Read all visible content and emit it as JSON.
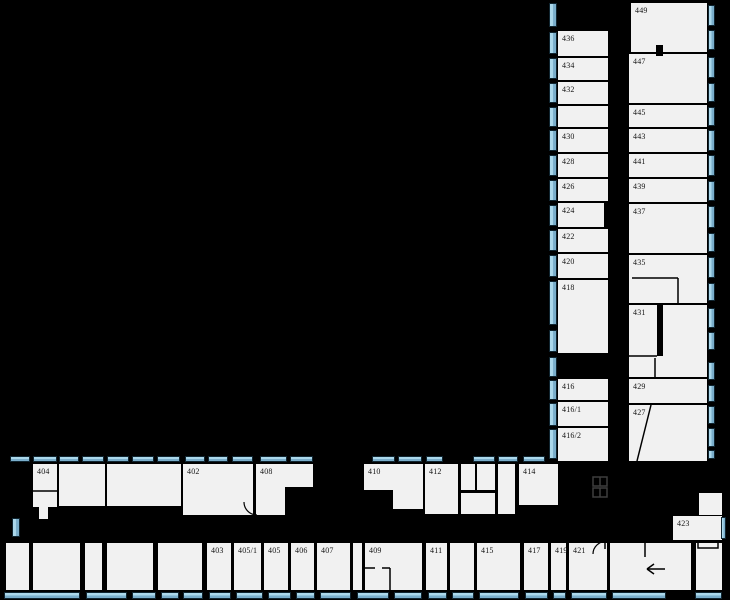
{
  "page": {
    "type": "building-floor-plan",
    "floor_hint": "rooms 402-449"
  },
  "canvas": {
    "width": 730,
    "height": 600
  },
  "colors": {
    "background": "#000000",
    "wall": "#000000",
    "room_fill": "#f1f1f1",
    "window_fill": "#8ec4e0",
    "window_border": "#102530",
    "label_text": "#161616",
    "shaft_symbol": "#3e3e3e"
  },
  "floorplan": {
    "room_labels": [
      "404",
      "402",
      "408",
      "410",
      "412",
      "414",
      "403",
      "405/1",
      "405",
      "406",
      "407",
      "409",
      "411",
      "415",
      "417",
      "419",
      "421",
      "423",
      "436",
      "434",
      "432",
      "430",
      "428",
      "426",
      "424",
      "422",
      "420",
      "418",
      "416",
      "416/1",
      "416/2",
      "449",
      "447",
      "445",
      "443",
      "441",
      "439",
      "437",
      "435",
      "431",
      "429",
      "427"
    ],
    "rooms": [
      {
        "label": "436",
        "x": 558,
        "y": 31,
        "w": 50,
        "h": 25
      },
      {
        "label": "434",
        "x": 558,
        "y": 58,
        "w": 50,
        "h": 22
      },
      {
        "label": "432",
        "x": 558,
        "y": 82,
        "w": 50,
        "h": 22
      },
      {
        "label": "",
        "x": 558,
        "y": 106,
        "w": 50,
        "h": 21
      },
      {
        "label": "430",
        "x": 558,
        "y": 129,
        "w": 50,
        "h": 23
      },
      {
        "label": "428",
        "x": 558,
        "y": 154,
        "w": 50,
        "h": 23
      },
      {
        "label": "426",
        "x": 558,
        "y": 179,
        "w": 50,
        "h": 22
      },
      {
        "label": "424",
        "x": 558,
        "y": 203,
        "w": 46,
        "h": 24
      },
      {
        "label": "422",
        "x": 558,
        "y": 229,
        "w": 50,
        "h": 23
      },
      {
        "label": "420",
        "x": 558,
        "y": 254,
        "w": 50,
        "h": 24
      },
      {
        "label": "418",
        "x": 558,
        "y": 280,
        "w": 50,
        "h": 73
      },
      {
        "label": "416",
        "x": 558,
        "y": 379,
        "w": 50,
        "h": 21
      },
      {
        "label": "416/1",
        "x": 558,
        "y": 402,
        "w": 50,
        "h": 24
      },
      {
        "label": "416/2",
        "x": 558,
        "y": 428,
        "w": 50,
        "h": 33
      },
      {
        "label": "449",
        "x": 631,
        "y": 3,
        "w": 76,
        "h": 49
      },
      {
        "label": "447",
        "x": 629,
        "y": 54,
        "w": 78,
        "h": 49
      },
      {
        "label": "445",
        "x": 629,
        "y": 105,
        "w": 78,
        "h": 22
      },
      {
        "label": "443",
        "x": 629,
        "y": 129,
        "w": 78,
        "h": 23
      },
      {
        "label": "441",
        "x": 629,
        "y": 154,
        "w": 78,
        "h": 23
      },
      {
        "label": "439",
        "x": 629,
        "y": 179,
        "w": 78,
        "h": 23
      },
      {
        "label": "437",
        "x": 629,
        "y": 204,
        "w": 78,
        "h": 49
      },
      {
        "label": "435",
        "x": 629,
        "y": 255,
        "w": 78,
        "h": 48
      },
      {
        "label": "431",
        "x": 629,
        "y": 305,
        "w": 78,
        "h": 72
      },
      {
        "label": "429",
        "x": 629,
        "y": 379,
        "w": 78,
        "h": 24
      },
      {
        "label": "427",
        "x": 629,
        "y": 405,
        "w": 78,
        "h": 56
      },
      {
        "label": "404",
        "x": 33,
        "y": 464,
        "w": 24,
        "h": 43
      },
      {
        "label": "",
        "x": 39,
        "y": 507,
        "w": 9,
        "h": 12
      },
      {
        "label": "",
        "x": 59,
        "y": 464,
        "w": 46,
        "h": 42
      },
      {
        "label": "",
        "x": 107,
        "y": 464,
        "w": 74,
        "h": 42
      },
      {
        "label": "402",
        "x": 183,
        "y": 464,
        "w": 70,
        "h": 51
      },
      {
        "label": "408",
        "x": 256,
        "y": 464,
        "w": 57,
        "h": 23
      },
      {
        "label": "",
        "x": 256,
        "y": 487,
        "w": 29,
        "h": 28
      },
      {
        "label": "410",
        "x": 364,
        "y": 464,
        "w": 59,
        "h": 26
      },
      {
        "label": "",
        "x": 393,
        "y": 490,
        "w": 30,
        "h": 19
      },
      {
        "label": "412",
        "x": 425,
        "y": 464,
        "w": 33,
        "h": 50
      },
      {
        "label": "",
        "x": 461,
        "y": 464,
        "w": 14,
        "h": 26
      },
      {
        "label": "",
        "x": 477,
        "y": 464,
        "w": 18,
        "h": 26
      },
      {
        "label": "",
        "x": 461,
        "y": 493,
        "w": 34,
        "h": 21
      },
      {
        "label": "",
        "x": 498,
        "y": 464,
        "w": 17,
        "h": 50
      },
      {
        "label": "414",
        "x": 519,
        "y": 464,
        "w": 39,
        "h": 41
      },
      {
        "label": "",
        "x": 6,
        "y": 543,
        "w": 23,
        "h": 47
      },
      {
        "label": "",
        "x": 33,
        "y": 543,
        "w": 47,
        "h": 47
      },
      {
        "label": "",
        "x": 85,
        "y": 543,
        "w": 17,
        "h": 47
      },
      {
        "label": "",
        "x": 107,
        "y": 543,
        "w": 46,
        "h": 47
      },
      {
        "label": "",
        "x": 158,
        "y": 543,
        "w": 44,
        "h": 47
      },
      {
        "label": "403",
        "x": 207,
        "y": 543,
        "w": 24,
        "h": 47
      },
      {
        "label": "405/1",
        "x": 234,
        "y": 543,
        "w": 27,
        "h": 47
      },
      {
        "label": "405",
        "x": 264,
        "y": 543,
        "w": 24,
        "h": 47
      },
      {
        "label": "406",
        "x": 291,
        "y": 543,
        "w": 23,
        "h": 47
      },
      {
        "label": "407",
        "x": 317,
        "y": 543,
        "w": 33,
        "h": 47
      },
      {
        "label": "",
        "x": 353,
        "y": 543,
        "w": 9,
        "h": 47
      },
      {
        "label": "409",
        "x": 365,
        "y": 543,
        "w": 57,
        "h": 47
      },
      {
        "label": "411",
        "x": 426,
        "y": 543,
        "w": 21,
        "h": 47
      },
      {
        "label": "",
        "x": 450,
        "y": 543,
        "w": 24,
        "h": 47
      },
      {
        "label": "415",
        "x": 477,
        "y": 543,
        "w": 43,
        "h": 47
      },
      {
        "label": "417",
        "x": 524,
        "y": 543,
        "w": 24,
        "h": 47
      },
      {
        "label": "419",
        "x": 551,
        "y": 543,
        "w": 15,
        "h": 47
      },
      {
        "label": "421",
        "x": 569,
        "y": 543,
        "w": 38,
        "h": 47
      },
      {
        "label": "",
        "x": 610,
        "y": 543,
        "w": 81,
        "h": 47
      },
      {
        "label": "",
        "x": 696,
        "y": 543,
        "w": 26,
        "h": 47
      },
      {
        "label": "423",
        "x": 673,
        "y": 516,
        "w": 49,
        "h": 24
      },
      {
        "label": "",
        "x": 699,
        "y": 493,
        "w": 23,
        "h": 22
      }
    ],
    "windows": [
      [
        10,
        456,
        20,
        6
      ],
      [
        33,
        456,
        24,
        6
      ],
      [
        59,
        456,
        20,
        6
      ],
      [
        82,
        456,
        22,
        6
      ],
      [
        107,
        456,
        22,
        6
      ],
      [
        132,
        456,
        22,
        6
      ],
      [
        157,
        456,
        23,
        6
      ],
      [
        185,
        456,
        20,
        6
      ],
      [
        208,
        456,
        20,
        6
      ],
      [
        232,
        456,
        21,
        6
      ],
      [
        260,
        456,
        27,
        6
      ],
      [
        290,
        456,
        23,
        6
      ],
      [
        372,
        456,
        23,
        6
      ],
      [
        398,
        456,
        24,
        6
      ],
      [
        426,
        456,
        17,
        6
      ],
      [
        473,
        456,
        22,
        6
      ],
      [
        498,
        456,
        20,
        6
      ],
      [
        523,
        456,
        22,
        6
      ],
      [
        4,
        592,
        76,
        7
      ],
      [
        86,
        592,
        41,
        7
      ],
      [
        132,
        592,
        24,
        7
      ],
      [
        161,
        592,
        18,
        7
      ],
      [
        183,
        592,
        20,
        7
      ],
      [
        209,
        592,
        22,
        7
      ],
      [
        236,
        592,
        27,
        7
      ],
      [
        268,
        592,
        23,
        7
      ],
      [
        296,
        592,
        19,
        7
      ],
      [
        320,
        592,
        31,
        7
      ],
      [
        357,
        592,
        32,
        7
      ],
      [
        394,
        592,
        28,
        7
      ],
      [
        428,
        592,
        19,
        7
      ],
      [
        452,
        592,
        22,
        7
      ],
      [
        479,
        592,
        40,
        7
      ],
      [
        525,
        592,
        23,
        7
      ],
      [
        553,
        592,
        13,
        7
      ],
      [
        571,
        592,
        36,
        7
      ],
      [
        612,
        592,
        54,
        7
      ],
      [
        695,
        592,
        27,
        7
      ],
      [
        549,
        3,
        8,
        24
      ],
      [
        549,
        32,
        8,
        22
      ],
      [
        549,
        58,
        8,
        21
      ],
      [
        549,
        83,
        8,
        20
      ],
      [
        549,
        107,
        8,
        20
      ],
      [
        549,
        130,
        8,
        21
      ],
      [
        549,
        155,
        8,
        21
      ],
      [
        549,
        180,
        8,
        21
      ],
      [
        549,
        205,
        8,
        21
      ],
      [
        549,
        230,
        8,
        21
      ],
      [
        549,
        255,
        8,
        22
      ],
      [
        549,
        281,
        8,
        44
      ],
      [
        549,
        330,
        8,
        22
      ],
      [
        549,
        357,
        8,
        20
      ],
      [
        549,
        380,
        8,
        20
      ],
      [
        549,
        403,
        8,
        23
      ],
      [
        549,
        429,
        8,
        30
      ],
      [
        708,
        5,
        7,
        21
      ],
      [
        708,
        30,
        7,
        20
      ],
      [
        708,
        57,
        7,
        21
      ],
      [
        708,
        83,
        7,
        19
      ],
      [
        708,
        107,
        7,
        19
      ],
      [
        708,
        130,
        7,
        21
      ],
      [
        708,
        155,
        7,
        21
      ],
      [
        708,
        181,
        7,
        20
      ],
      [
        708,
        206,
        7,
        22
      ],
      [
        708,
        233,
        7,
        19
      ],
      [
        708,
        257,
        7,
        21
      ],
      [
        708,
        283,
        7,
        18
      ],
      [
        708,
        308,
        7,
        20
      ],
      [
        708,
        332,
        7,
        18
      ],
      [
        708,
        362,
        7,
        18
      ],
      [
        708,
        385,
        7,
        17
      ],
      [
        708,
        406,
        7,
        18
      ],
      [
        708,
        428,
        7,
        19
      ],
      [
        708,
        450,
        7,
        9
      ],
      [
        12,
        518,
        8,
        19
      ],
      [
        721,
        517,
        5,
        22
      ]
    ],
    "symbols": [
      {
        "t": "rect",
        "name": "door-leaf",
        "x": 656,
        "y": 45,
        "w": 7,
        "h": 11,
        "fill": "#000000"
      },
      {
        "t": "rect",
        "name": "wall-segment",
        "x": 657,
        "y": 305,
        "w": 6,
        "h": 51,
        "fill": "#000000"
      },
      {
        "t": "rect",
        "name": "shaft-symbol",
        "x": 593,
        "y": 477,
        "w": 14,
        "h": 9,
        "stroke": "#3e3e3e"
      },
      {
        "t": "rect",
        "name": "shaft-symbol",
        "x": 593,
        "y": 488,
        "w": 14,
        "h": 9,
        "stroke": "#3e3e3e"
      },
      {
        "t": "line",
        "name": "shaft-divider",
        "x1": 600,
        "y1": 477,
        "x2": 600,
        "y2": 486,
        "stroke": "#3e3e3e"
      },
      {
        "t": "line",
        "name": "shaft-divider",
        "x1": 600,
        "y1": 488,
        "x2": 600,
        "y2": 497,
        "stroke": "#3e3e3e"
      },
      {
        "t": "rect",
        "name": "alcove-outline",
        "x": 698,
        "y": 541,
        "w": 20,
        "h": 7,
        "stroke": "#000000"
      },
      {
        "t": "line",
        "name": "wall-line",
        "x1": 33,
        "y1": 491,
        "x2": 57,
        "y2": 491
      },
      {
        "t": "line",
        "name": "wall-line",
        "x1": 629,
        "y1": 356,
        "x2": 657,
        "y2": 356
      },
      {
        "t": "line",
        "name": "wall-line",
        "x1": 655,
        "y1": 358,
        "x2": 655,
        "y2": 377
      },
      {
        "t": "line",
        "name": "wall-line",
        "x1": 632,
        "y1": 278,
        "x2": 678,
        "y2": 278
      },
      {
        "t": "line",
        "name": "wall-line",
        "x1": 678,
        "y1": 278,
        "x2": 678,
        "y2": 303
      },
      {
        "t": "line",
        "name": "diagonal-wall",
        "x1": 651,
        "y1": 405,
        "x2": 637,
        "y2": 461
      },
      {
        "t": "line",
        "name": "wall-line",
        "x1": 365,
        "y1": 568,
        "x2": 375,
        "y2": 568
      },
      {
        "t": "line",
        "name": "wall-line",
        "x1": 382,
        "y1": 568,
        "x2": 390,
        "y2": 568
      },
      {
        "t": "line",
        "name": "wall-line",
        "x1": 390,
        "y1": 568,
        "x2": 390,
        "y2": 590
      },
      {
        "t": "line",
        "name": "wall-line",
        "x1": 605,
        "y1": 541,
        "x2": 605,
        "y2": 549
      },
      {
        "t": "line",
        "name": "wall-stub",
        "x1": 645,
        "y1": 543,
        "x2": 645,
        "y2": 557
      },
      {
        "t": "line",
        "name": "entrance-arrow",
        "x1": 665,
        "y1": 569,
        "x2": 647,
        "y2": 569
      },
      {
        "t": "line",
        "name": "entrance-arrow",
        "x1": 647,
        "y1": 569,
        "x2": 654,
        "y2": 564
      },
      {
        "t": "line",
        "name": "entrance-arrow",
        "x1": 647,
        "y1": 569,
        "x2": 654,
        "y2": 574
      },
      {
        "t": "path",
        "name": "door-swing-arc",
        "d": "M244,502 A13,13 0 0 0 257,515"
      },
      {
        "t": "path",
        "name": "door-swing-arc",
        "d": "M593,554 A14,13 0 0 1 607,541"
      }
    ]
  }
}
